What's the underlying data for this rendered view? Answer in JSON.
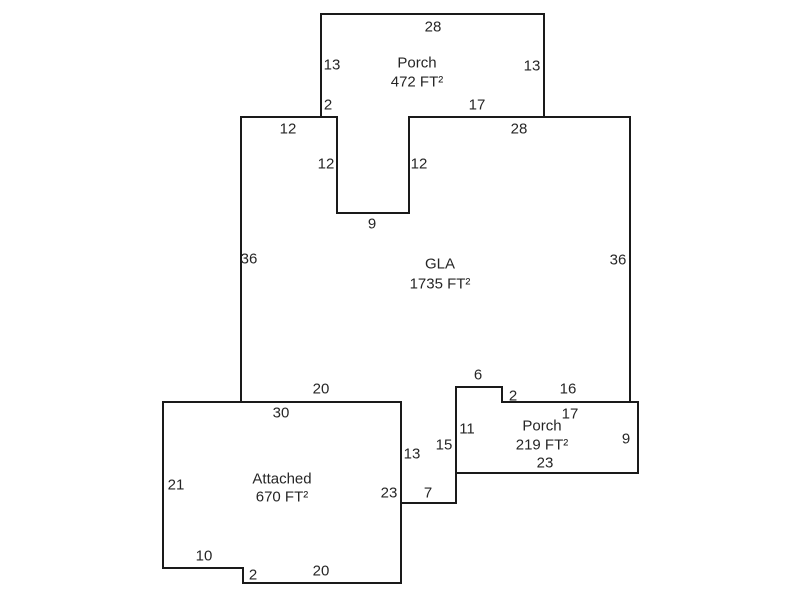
{
  "canvas": {
    "width": 800,
    "height": 600,
    "background": "#ffffff",
    "stroke_color": "#1a1a1a",
    "stroke_width": 2,
    "text_color": "#262626",
    "font_size": 15
  },
  "areas": [
    {
      "name": "porch-top",
      "label_lines": [
        "Porch",
        "472 FT²"
      ],
      "label_x": 417,
      "label_y": 62,
      "line_height": 19,
      "points": [
        [
          321,
          14
        ],
        [
          544,
          14
        ],
        [
          544,
          117
        ],
        [
          409,
          117
        ],
        [
          409,
          213
        ],
        [
          337,
          213
        ],
        [
          337,
          117
        ],
        [
          321,
          117
        ]
      ]
    },
    {
      "name": "gla",
      "label_lines": [
        "GLA",
        "1735 FT²"
      ],
      "label_x": 440,
      "label_y": 263,
      "line_height": 20,
      "points": [
        [
          241,
          117
        ],
        [
          337,
          117
        ],
        [
          337,
          213
        ],
        [
          409,
          213
        ],
        [
          409,
          117
        ],
        [
          630,
          117
        ],
        [
          630,
          402
        ],
        [
          502,
          402
        ],
        [
          502,
          387
        ],
        [
          456,
          387
        ],
        [
          456,
          503
        ],
        [
          401,
          503
        ],
        [
          401,
          402
        ],
        [
          241,
          402
        ]
      ]
    },
    {
      "name": "porch-bottom-right",
      "label_lines": [
        "Porch",
        "219 FT²"
      ],
      "label_x": 542,
      "label_y": 425,
      "line_height": 19,
      "points": [
        [
          456,
          387
        ],
        [
          502,
          387
        ],
        [
          502,
          402
        ],
        [
          638,
          402
        ],
        [
          638,
          473
        ],
        [
          456,
          473
        ]
      ]
    },
    {
      "name": "attached-garage",
      "label_lines": [
        "Attached",
        "670 FT²"
      ],
      "label_x": 282,
      "label_y": 478,
      "line_height": 18,
      "points": [
        [
          163,
          402
        ],
        [
          401,
          402
        ],
        [
          401,
          583
        ],
        [
          243,
          583
        ],
        [
          243,
          568
        ],
        [
          163,
          568
        ]
      ]
    }
  ],
  "dimension_labels": [
    {
      "name": "porch1-top",
      "text": "28",
      "x": 433,
      "y": 26
    },
    {
      "name": "porch1-left",
      "text": "13",
      "x": 332,
      "y": 64
    },
    {
      "name": "porch1-right",
      "text": "13",
      "x": 532,
      "y": 65
    },
    {
      "name": "porch1-bottom-left",
      "text": "2",
      "x": 328,
      "y": 104
    },
    {
      "name": "porch1-bottom-right",
      "text": "17",
      "x": 477,
      "y": 104
    },
    {
      "name": "gla-top-left",
      "text": "12",
      "x": 288,
      "y": 128
    },
    {
      "name": "gla-top-right",
      "text": "28",
      "x": 519,
      "y": 128
    },
    {
      "name": "notch-left",
      "text": "12",
      "x": 326,
      "y": 163
    },
    {
      "name": "notch-right",
      "text": "12",
      "x": 419,
      "y": 163
    },
    {
      "name": "notch-bottom",
      "text": "9",
      "x": 372,
      "y": 223
    },
    {
      "name": "gla-left",
      "text": "36",
      "x": 249,
      "y": 258
    },
    {
      "name": "gla-right",
      "text": "36",
      "x": 618,
      "y": 259
    },
    {
      "name": "gla-bottom-left",
      "text": "20",
      "x": 321,
      "y": 388
    },
    {
      "name": "attached-top",
      "text": "30",
      "x": 281,
      "y": 412
    },
    {
      "name": "gla-step-top",
      "text": "6",
      "x": 478,
      "y": 374
    },
    {
      "name": "gla-bottom-right",
      "text": "16",
      "x": 568,
      "y": 388
    },
    {
      "name": "porch2-step",
      "text": "2",
      "x": 513,
      "y": 395
    },
    {
      "name": "porch2-top",
      "text": "17",
      "x": 570,
      "y": 413
    },
    {
      "name": "porch2-left",
      "text": "11",
      "x": 467,
      "y": 428
    },
    {
      "name": "porch2-right",
      "text": "9",
      "x": 626,
      "y": 438
    },
    {
      "name": "gla-strip-left",
      "text": "15",
      "x": 444,
      "y": 444
    },
    {
      "name": "gla-strip-right",
      "text": "13",
      "x": 412,
      "y": 453
    },
    {
      "name": "porch2-bottom",
      "text": "23",
      "x": 545,
      "y": 462
    },
    {
      "name": "attached-right",
      "text": "23",
      "x": 389,
      "y": 492
    },
    {
      "name": "gla-strip-bottom",
      "text": "7",
      "x": 428,
      "y": 492
    },
    {
      "name": "attached-left",
      "text": "21",
      "x": 176,
      "y": 484
    },
    {
      "name": "attached-bottom-step",
      "text": "10",
      "x": 204,
      "y": 555
    },
    {
      "name": "attached-bottom",
      "text": "20",
      "x": 321,
      "y": 570
    },
    {
      "name": "attached-step",
      "text": "2",
      "x": 253,
      "y": 574
    }
  ]
}
